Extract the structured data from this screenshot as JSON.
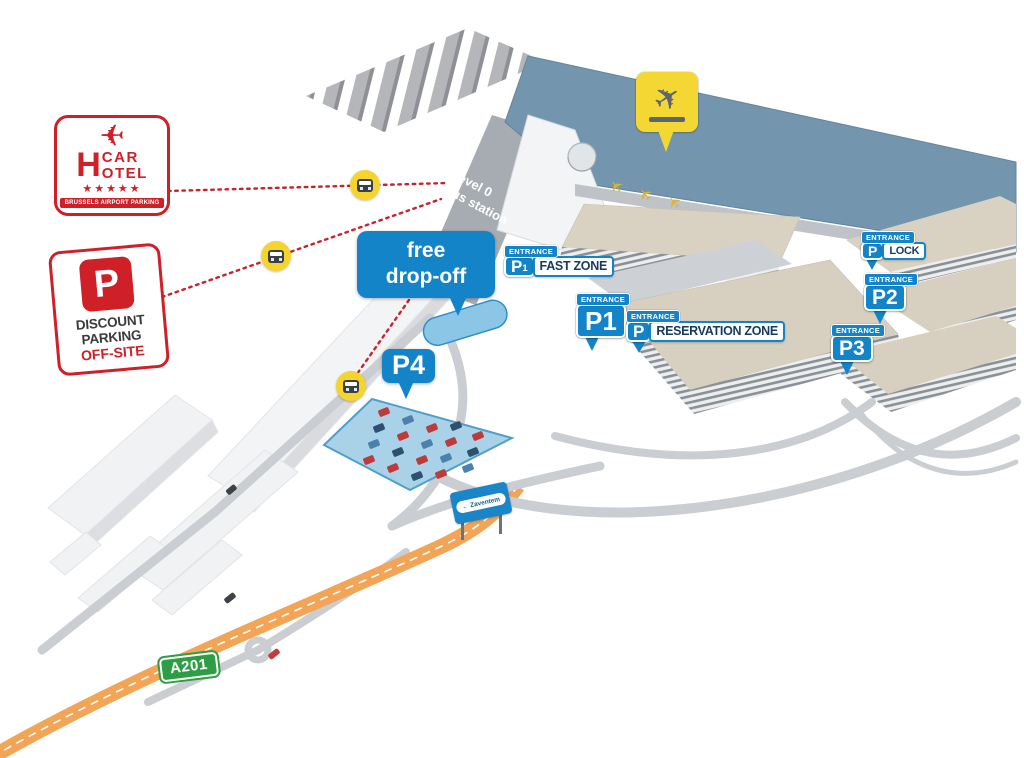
{
  "signs": {
    "car_hotel": {
      "h": "H",
      "top": "CAR",
      "bottom": "OTEL",
      "stars": "★★★★★",
      "tagline": "BRUSSELS AIRPORT PARKING"
    },
    "discount_parking": {
      "p": "P",
      "line1": "DISCOUNT",
      "line2": "PARKING",
      "line3": "OFF-SITE"
    },
    "a201": {
      "label": "A201"
    },
    "zaventem": {
      "label": "← Zaventem"
    }
  },
  "labels": {
    "entrance": "ENTRANCE",
    "free_dropoff": {
      "line1": "free",
      "line2": "drop-off"
    },
    "level0": {
      "line1": "Level 0",
      "line2": "Bus station"
    },
    "fast_zone": {
      "p": "P",
      "sub": "1",
      "zone": "FAST ZONE"
    },
    "p1": {
      "p": "P1"
    },
    "reservation": {
      "p": "P",
      "zone": "RESERVATION ZONE"
    },
    "lock": {
      "p": "P",
      "zone": "LOCK"
    },
    "p2": {
      "p": "P2"
    },
    "p3": {
      "p": "P3"
    },
    "p4": {
      "p": "P4"
    }
  },
  "icons": {
    "airplane": "✈",
    "bus": "bus-front",
    "star": "★"
  },
  "colors": {
    "label_blue": "#1484c8",
    "brand_red": "#cf2028",
    "bus_yellow": "#f6d42e",
    "terminal_blue": "#7396ae",
    "highway_orange": "#f2a556",
    "sign_green": "#2d9e45",
    "dotted_red": "#c8232b",
    "p4_lot_blue": "#a9d2e8"
  }
}
